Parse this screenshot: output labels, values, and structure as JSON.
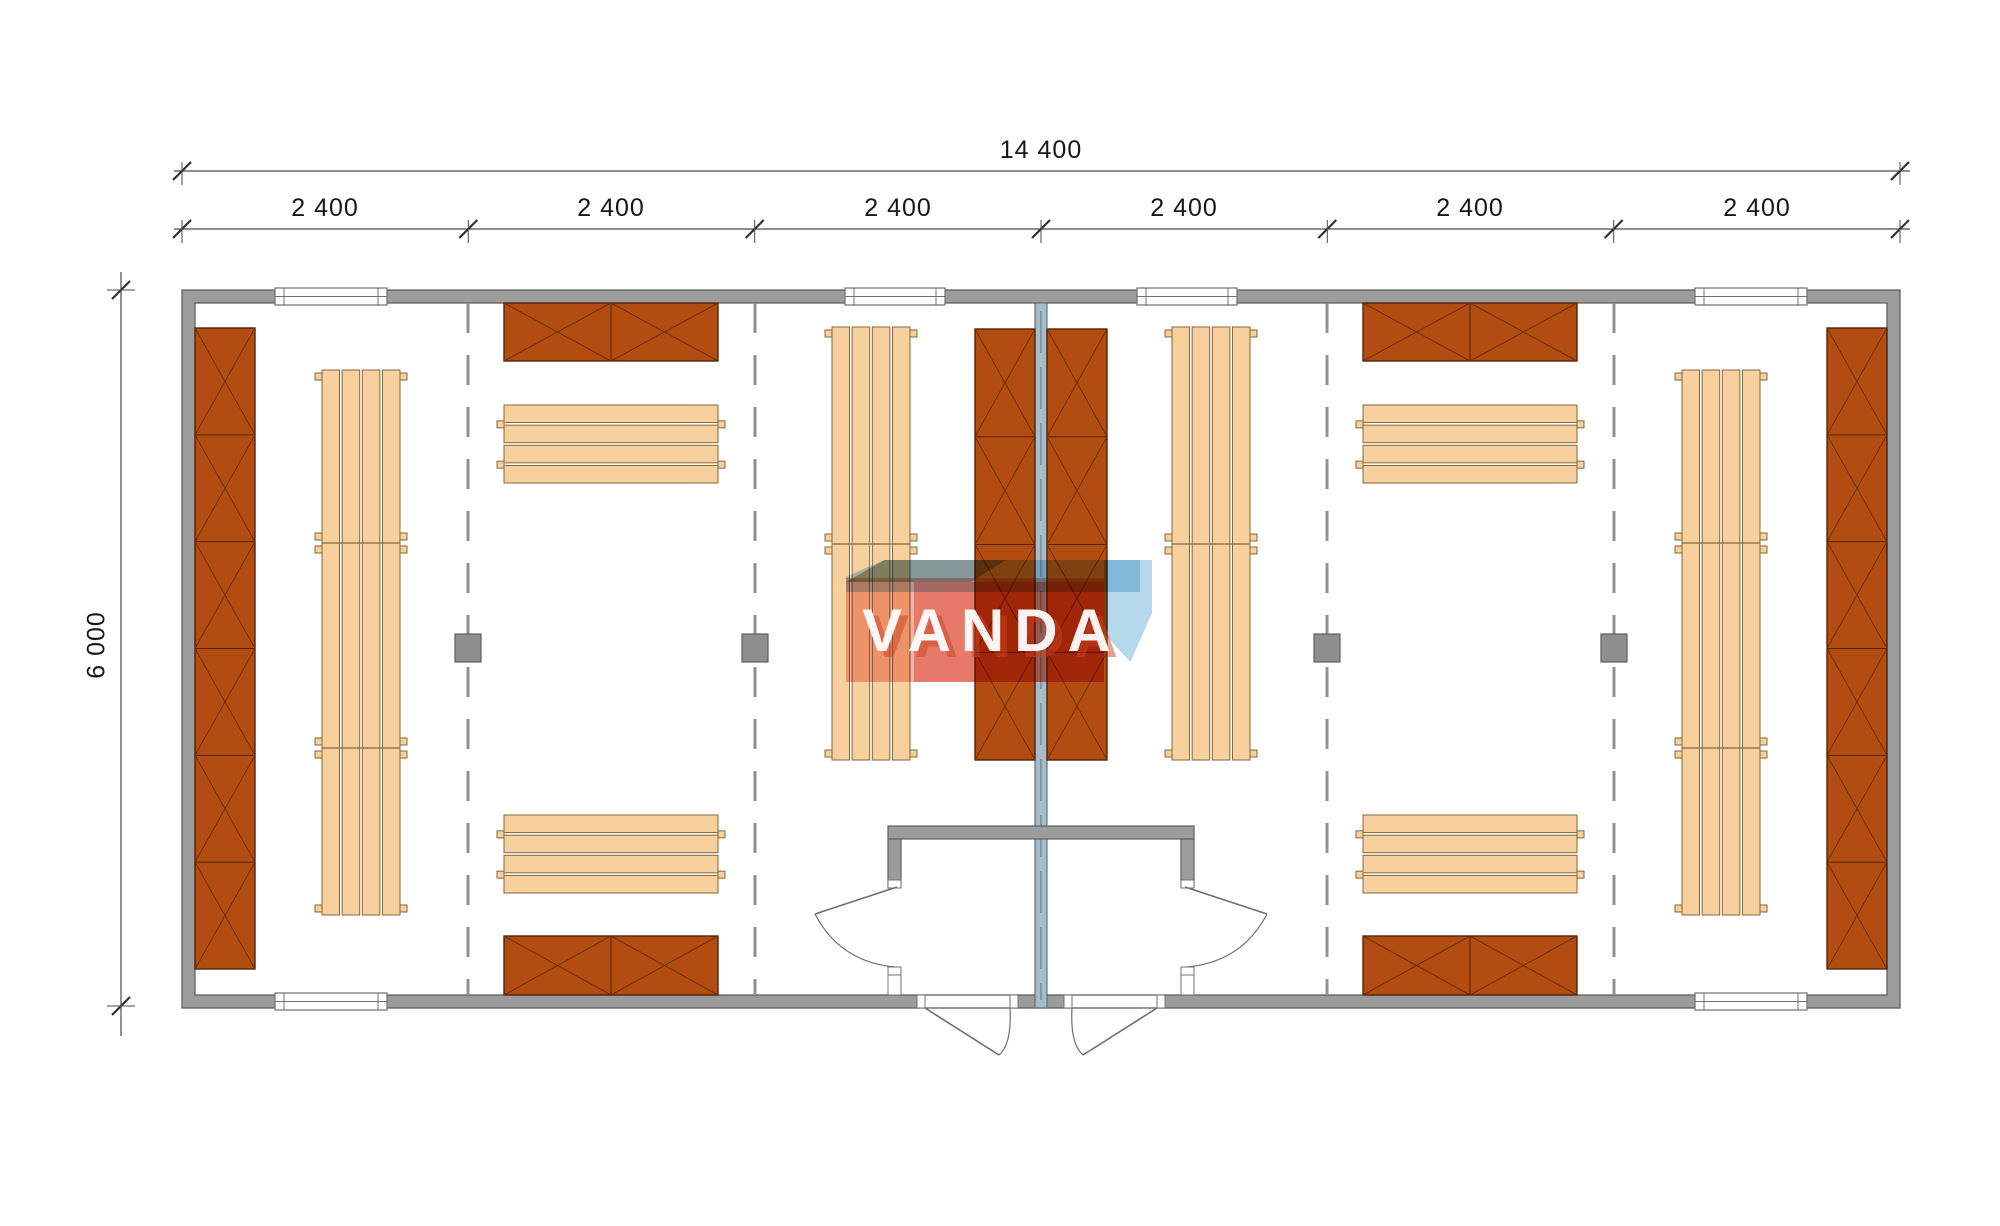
{
  "title": "modular-building-floor-plan",
  "dimensions": {
    "total": "14 400",
    "modules": [
      "2 400",
      "2 400",
      "2 400",
      "2 400",
      "2 400",
      "2 400"
    ],
    "height": "6 000"
  },
  "watermark": {
    "text": "VANDA"
  },
  "colors": {
    "wall_fill": "#9c9c9c",
    "wall_stroke": "#606060",
    "partition_fill": "#a6bcca",
    "partition_stroke": "#5d707d",
    "crosshatch_fill": "#b24c10",
    "crosshatch_stroke": "#52240a",
    "crosshatch_line": "#6d3009",
    "bench_fill": "#f8d09e",
    "bench_stroke": "#80683c",
    "grid_dash": "#909090",
    "column_fill": "#8f8f8f",
    "dim_line": "#4a4a4a",
    "dim_tick": "#303030",
    "door_line": "#6f6f6f",
    "window_fill": "#ffffff",
    "window_stroke": "#707070"
  },
  "plan": {
    "building": {
      "x": 182,
      "y": 290,
      "w": 1718,
      "h": 718,
      "wall": 13
    },
    "dim_row_total_y": 171,
    "dim_row_modules_y": 229,
    "dim_col_x": 121,
    "module_ticks_x": [
      182,
      468.3,
      754.7,
      1041,
      1327.3,
      1613.7,
      1900
    ],
    "grid_lines_x": [
      468,
      755,
      1327,
      1614
    ],
    "columns": {
      "xs": [
        468,
        755,
        1327,
        1614
      ],
      "y": 634,
      "w": 26,
      "h": 28
    },
    "central_wall": {
      "x": 1035,
      "y": 303,
      "w": 12,
      "h": 705
    },
    "windows_top": [
      {
        "x": 275,
        "w": 112
      },
      {
        "x": 845,
        "w": 100
      },
      {
        "x": 1137,
        "w": 100
      },
      {
        "x": 1695,
        "w": 112
      }
    ],
    "windows_bottom": [
      {
        "x": 275,
        "w": 112
      },
      {
        "x": 1695,
        "w": 112
      }
    ],
    "crosshatch_units": [
      {
        "name": "wall-panel-left",
        "x": 195,
        "y": 328,
        "w": 60,
        "h": 641,
        "sections": 6,
        "dir": "v"
      },
      {
        "name": "wall-panel-right",
        "x": 1827,
        "y": 328,
        "w": 60,
        "h": 641,
        "sections": 6,
        "dir": "v"
      },
      {
        "name": "center-panel-left",
        "x": 975,
        "y": 329,
        "w": 60,
        "h": 431,
        "sections": 4,
        "dir": "v"
      },
      {
        "name": "center-panel-right",
        "x": 1047,
        "y": 329,
        "w": 60,
        "h": 431,
        "sections": 4,
        "dir": "v"
      },
      {
        "name": "storage-box-top-left",
        "x": 504,
        "y": 303,
        "w": 214,
        "h": 58,
        "sections": 2,
        "dir": "h"
      },
      {
        "name": "storage-box-top-right",
        "x": 1363,
        "y": 303,
        "w": 214,
        "h": 58,
        "sections": 2,
        "dir": "h"
      },
      {
        "name": "storage-box-bottom-left",
        "x": 504,
        "y": 936,
        "w": 214,
        "h": 59,
        "sections": 2,
        "dir": "h"
      },
      {
        "name": "storage-box-bottom-right",
        "x": 1363,
        "y": 936,
        "w": 214,
        "h": 59,
        "sections": 2,
        "dir": "h"
      }
    ],
    "v_benches": [
      {
        "name": "bench-group-module1",
        "x": 322,
        "y": 370,
        "w": 78,
        "h": 545,
        "divs": [
          543,
          748
        ]
      },
      {
        "name": "bench-group-module6",
        "x": 1682,
        "y": 370,
        "w": 78,
        "h": 545,
        "divs": [
          543,
          748
        ]
      },
      {
        "name": "bench-group-module3",
        "x": 832,
        "y": 327,
        "w": 78,
        "h": 433,
        "divs": [
          544
        ]
      },
      {
        "name": "bench-group-module4",
        "x": 1172,
        "y": 327,
        "w": 78,
        "h": 433,
        "divs": [
          544
        ]
      }
    ],
    "h_benches": [
      {
        "name": "bench-top-module2",
        "x": 504,
        "y": 405,
        "w": 214,
        "h": 78
      },
      {
        "name": "bench-top-module5",
        "x": 1363,
        "y": 405,
        "w": 214,
        "h": 78
      },
      {
        "name": "bench-bottom-module2",
        "x": 504,
        "y": 815,
        "w": 214,
        "h": 78
      },
      {
        "name": "bench-bottom-module5",
        "x": 1363,
        "y": 815,
        "w": 214,
        "h": 78
      }
    ],
    "vestibule": {
      "top_wall": {
        "x": 888,
        "y": 826,
        "w": 306,
        "h": 13
      },
      "stubs": [
        {
          "x": 888,
          "y": 839,
          "w": 13,
          "h": 48
        },
        {
          "x": 1181,
          "y": 839,
          "w": 13,
          "h": 48
        }
      ],
      "white_pieces": [
        {
          "x": 888,
          "y": 880,
          "w": 13,
          "h": 8
        },
        {
          "x": 888,
          "y": 967,
          "w": 13,
          "h": 8
        },
        {
          "x": 1181,
          "y": 880,
          "w": 13,
          "h": 8
        },
        {
          "x": 1181,
          "y": 967,
          "w": 13,
          "h": 8
        },
        {
          "x": 888,
          "y": 975,
          "w": 13,
          "h": 20
        },
        {
          "x": 1181,
          "y": 975,
          "w": 13,
          "h": 20
        }
      ]
    },
    "bottom_wall_segments": [
      {
        "x": 182,
        "w": 735
      },
      {
        "x": 1018,
        "w": 47
      },
      {
        "x": 1165,
        "w": 735
      }
    ],
    "bottom_jambs": [
      {
        "x": 917
      },
      {
        "x": 1010
      },
      {
        "x": 1064
      },
      {
        "x": 1157
      }
    ],
    "side_doors": [
      {
        "leaf": [
          897,
          887,
          815,
          914
        ],
        "arc": "M 815 914 Q 840 962 895 967"
      },
      {
        "leaf": [
          1185,
          887,
          1267,
          914
        ],
        "arc": "M 1267 914 Q 1242 962 1187 967"
      }
    ],
    "exterior_doors": [
      {
        "leaf": [
          925,
          1008,
          999,
          1055
        ],
        "arc": "M 1010 1008 Q 1012 1044 999 1055"
      },
      {
        "leaf": [
          1157,
          1008,
          1083,
          1055
        ],
        "arc": "M 1072 1008 Q 1070 1044 1083 1055"
      }
    ]
  }
}
